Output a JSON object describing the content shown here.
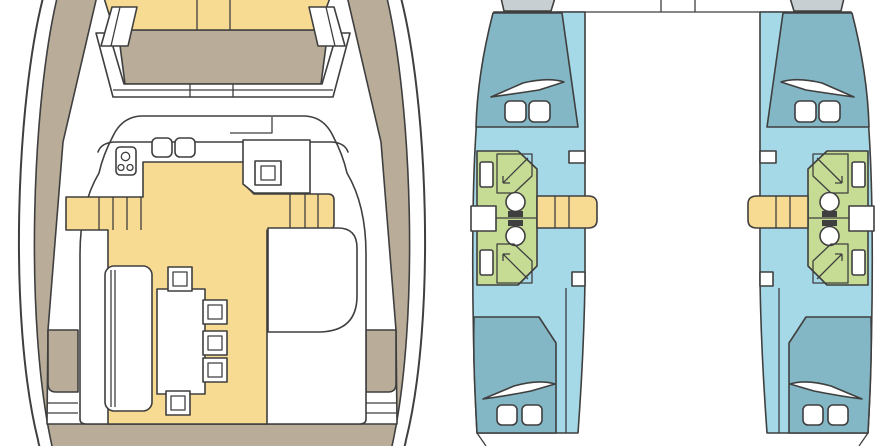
{
  "diagram": {
    "kind": "catamaran-floor-plan",
    "views": {
      "deck_plan": {
        "label": "main-deck-view",
        "features": [
          "bow-seat",
          "foredeck-lounge",
          "galley-stove",
          "galley-double-sink",
          "oven",
          "companionway-steps-port",
          "companionway-steps-starboard",
          "dining-table",
          "stools",
          "bench-sofa",
          "settee",
          "aft-deck",
          "transom-steps"
        ]
      },
      "hull_plan": {
        "label": "hulls-cabins-view",
        "hulls": [
          {
            "side": "port",
            "forward_cabin": "double-berth",
            "aft_cabin": "double-berth",
            "bathrooms": 2,
            "fixtures": [
              "toilet",
              "shower",
              "washbasin",
              "steps"
            ]
          },
          {
            "side": "starboard",
            "forward_cabin": "double-berth",
            "aft_cabin": "double-berth",
            "bathrooms": 2,
            "fixtures": [
              "toilet",
              "shower",
              "washbasin",
              "steps"
            ]
          }
        ]
      }
    }
  },
  "colors": {
    "outline": "#3f3f3f",
    "deck": "#b9ad99",
    "sole": "#f8db92",
    "hull": "#a6d9e8",
    "bed": "#84b7c5",
    "bath": "#c6dc95",
    "bow_tip": "#c7cfd2",
    "white": "#ffffff",
    "background": "#ffffff"
  }
}
